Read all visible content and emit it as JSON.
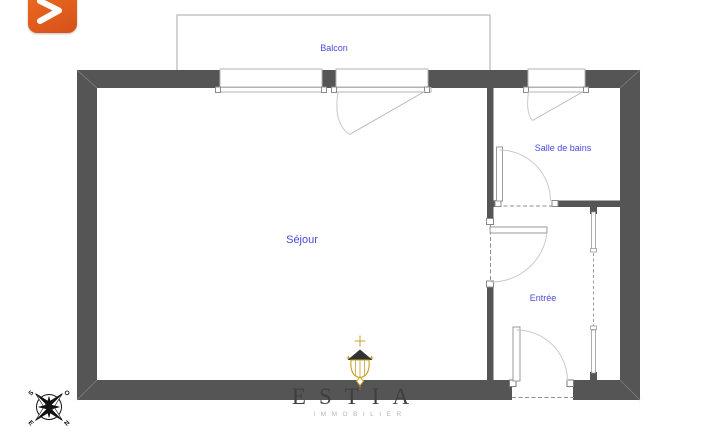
{
  "logo": {
    "icon": "chevron-right-plus-icon",
    "accent_color": "#e05d1c"
  },
  "floorplan": {
    "wall_color": "#555555",
    "label_color": "#4949db",
    "rooms": [
      {
        "label": "Balcon"
      },
      {
        "label": "Séjour"
      },
      {
        "label": "Salle de bains"
      },
      {
        "label": "Entrée"
      }
    ]
  },
  "compass": {
    "north": "N",
    "south": "S",
    "east": "E",
    "west": "O"
  },
  "watermark": {
    "brand": "ESTIA",
    "tagline": "IMMOBILIER"
  },
  "icons": {
    "chandelier": "chandelier-icon",
    "compass": "compass-rose-icon"
  }
}
